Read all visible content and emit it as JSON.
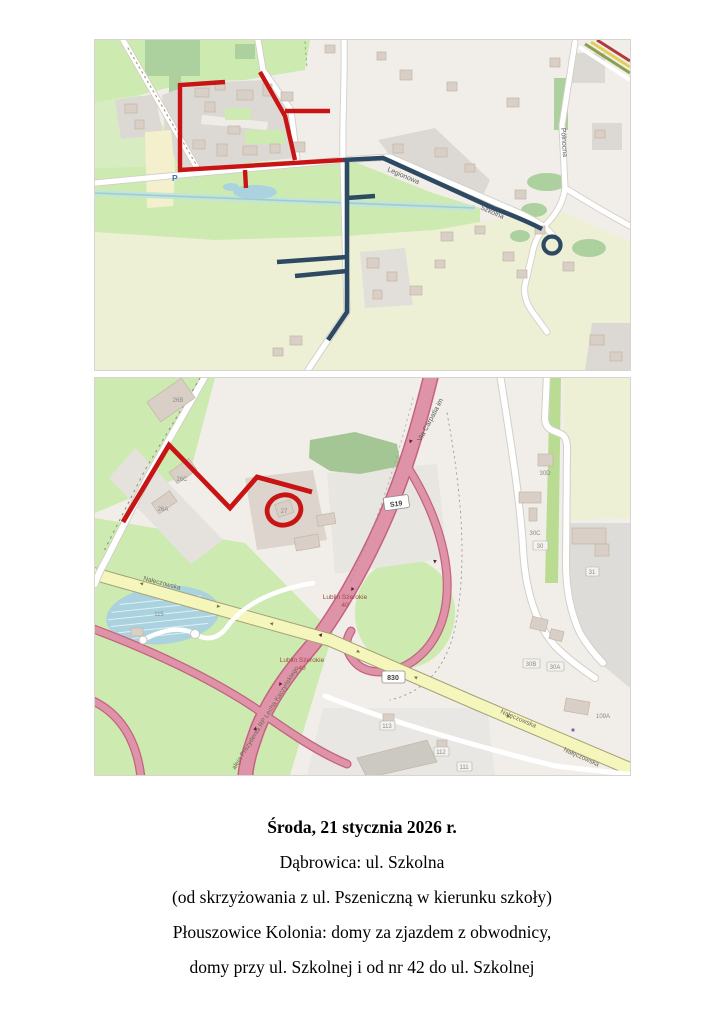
{
  "notice": {
    "title": "Środa, 21 stycznia 2026 r.",
    "line1": "Dąbrowica: ul. Szkolna",
    "line2": "(od skrzyżowania z ul. Pszeniczną w kierunku szkoły)",
    "line3": "Płouszowice Kolonia: domy za zjazdem z obwodnicy,",
    "line4": "domy przy ul. Szkolnej i od nr 42 do ul. Szkolnej"
  },
  "colors": {
    "route_closed_red": "#c81414",
    "route_detour_navy": "#2e4a63",
    "motorway_pink": "#de93a9",
    "secondary_yellow": "#f5f6bc",
    "water_blue": "#aad3df"
  },
  "map_top": {
    "street_legionowa": "Legionowa",
    "street_szkolna": "Szkolna",
    "street_polnocna": "Północna",
    "parking": "P"
  },
  "map_bottom": {
    "highway_name": "Via Carpatia im",
    "highway_ref": "S19",
    "road_ref_830": "830",
    "street_naleczowska": "Nałęczowska",
    "avenue_aleja": "aleja Prezydenta RP Lecha Kaczyńskiego",
    "bus_stop_name": "Lublin Szerokie",
    "bus_stop_ref_a": "40",
    "bus_stop_ref_b": "40",
    "pond_ref": "115",
    "b_26b": "26B",
    "b_26c": "26C",
    "b_26a": "26A",
    "b_27": "27",
    "b_30d": "30D",
    "b_30c": "30C",
    "b_30": "30",
    "b_31": "31",
    "b_30b": "30B",
    "b_30a": "30A",
    "b_109a": "109A",
    "b_113": "113",
    "b_112": "112",
    "b_111": "111"
  }
}
